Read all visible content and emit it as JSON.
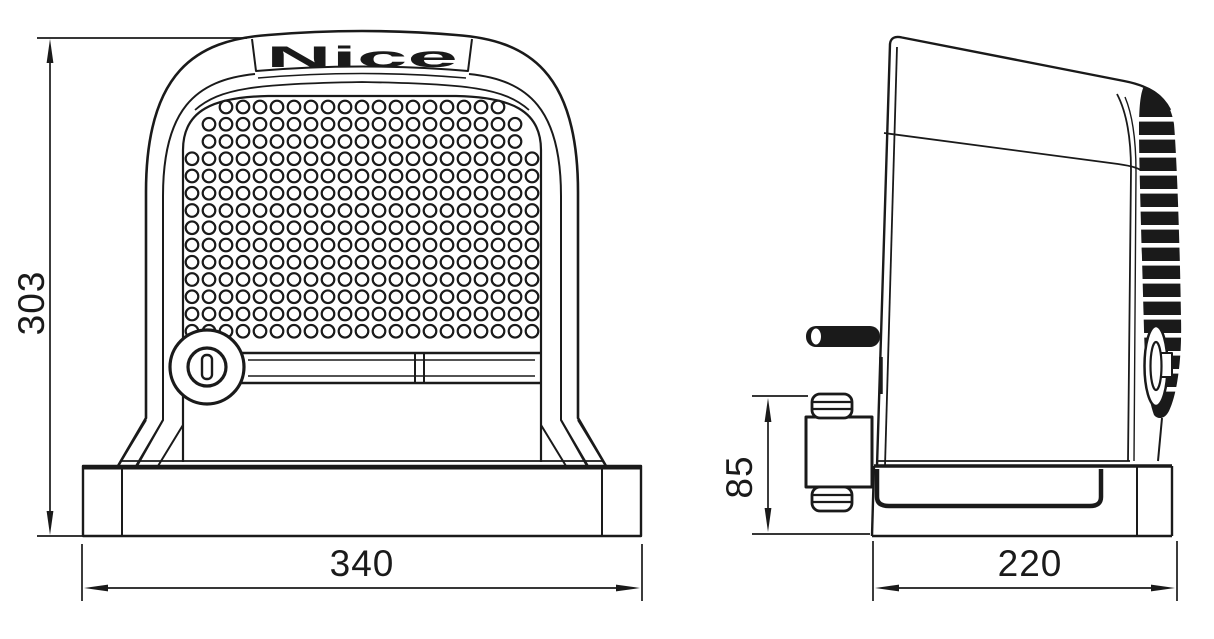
{
  "logo": {
    "text": "Nice"
  },
  "dimensions": {
    "overall_height": "303",
    "overall_width": "340",
    "pinion_height": "85",
    "depth": "220"
  },
  "colors": {
    "line": "#1a1a1a",
    "background": "#ffffff"
  }
}
